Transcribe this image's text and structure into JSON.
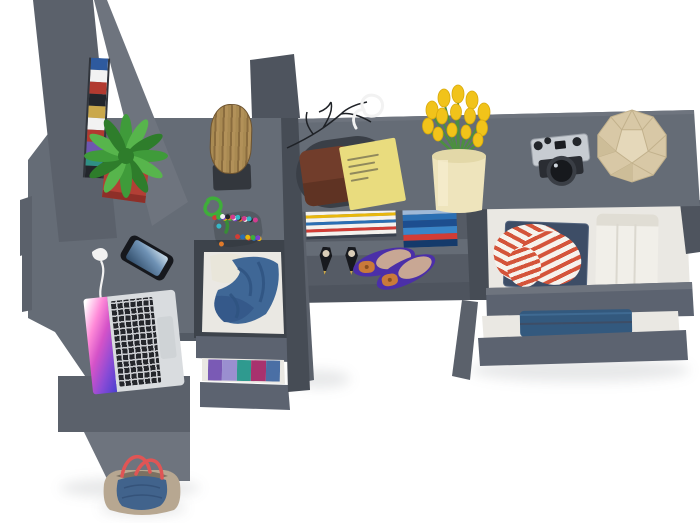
{
  "scene": {
    "kind": "3d-render-top-view",
    "background": "#ffffff"
  },
  "labels": {
    "scene": "furniture set top view",
    "wardrobe": "wardrobe columns",
    "left_desk": "corner desk",
    "middle_dresser": "dresser with open clothing drawers",
    "right_desk": "desk with open shelves",
    "chest": "chest with open drawers",
    "chair": "chair",
    "stool": "wooden log stool",
    "plant": "potted fern plant",
    "laptop": "open laptop",
    "phone": "smartphone",
    "earbuds": "white earphones",
    "pompom": "pompom toy",
    "tray": "valet tray",
    "wallet": "leather wallet",
    "notepad": "yellow notepad",
    "glasses": "white glasses",
    "branches": "decorative branches",
    "tulips": "yellow tulips in vase",
    "camera": "vintage camera",
    "polyhedron": "geometric decor object",
    "magazines": "magazine stack",
    "books": "book stack",
    "heels": "black high heels",
    "flats": "purple ballet flats",
    "shirt": "striped shirt",
    "trousers": "white folded trousers",
    "jeans": "folded jeans",
    "jacket": "denim jacket",
    "clothes": "folded colorful clothes",
    "bag": "tote bag"
  },
  "colors": {
    "surface": "#656c76",
    "panel": "#5b616b",
    "panelLight": "#6e747e",
    "dark": "#464c55",
    "deep": "#3d434b",
    "front": "#5c6370",
    "cavity": "#555b65",
    "edge": "#4e545e",
    "edgeDark": "#535a64",
    "drawerWhite": "#eae8e3",
    "potRed": "#b23f35",
    "potRedDark": "#8e2f28",
    "fern1": "#3f9b3a",
    "fern2": "#57b54c",
    "fern3": "#2e7d2b",
    "rope": "#3fae3a",
    "stems": "#4c8f3f",
    "wood": "#a98a52",
    "woodDark": "#8a6c3e",
    "woodLight": "#b29159",
    "stoolBase": "#33373d",
    "phoneBody": "#16181d",
    "silver": "#d9dcdf",
    "keys": "#24262b",
    "tray": "#3a3f47",
    "wallet": "#713d2b",
    "walletDark": "#5f3323",
    "notepad": "#e9dc7e",
    "scribble": "#90895c",
    "tulip": "#f1c31a",
    "vase": "#eee4bc",
    "vaseShade": "#e3d8a8",
    "camSilver": "#c7ccd2",
    "camBlack": "#23262b",
    "camBody": "#2a2d33",
    "poly": "#d8c8a6",
    "polyLine": "#c2b18c",
    "polyLight": "#e5d8ba",
    "polyDark": "#cdbd98",
    "heel": "#17191e",
    "gold": "#caa84c",
    "insole": "#d9cdb8",
    "flat": "#4b2fa8",
    "flatIn": "#c8a794",
    "bow": "#c97a3a",
    "stripeRed": "#d4543a",
    "shirtWhite": "#f6f2ec",
    "jeansDark": "#3d4d66",
    "jeansMid": "#33597e",
    "jeansLight": "#3f6a92",
    "trousers": "#f1efe9",
    "trousersShade": "#e0ddd4",
    "denim": "#3f6796",
    "denimDark": "#2e5280",
    "denimDeep": "#35598a",
    "garment": "#e9e6da",
    "bagBeige": "#b7a791",
    "bagDenim": "#41638c",
    "bagHandle": "#e05555",
    "bagInner": "#7c7162",
    "branch": "#1f2227",
    "cord": "#f2f2f2"
  },
  "stripes": {
    "book_spines": [
      "#2e5a9e",
      "#f2f2f2",
      "#b23a30",
      "#23262c",
      "#caa84c",
      "#f2f2f2",
      "#b23a30",
      "#6f57b0",
      "#2f8f85",
      "#23262c"
    ],
    "magazines": [
      "#f4f2ee",
      "#e8b70d",
      "#f4f2ee",
      "#2b6fb3",
      "#f4f2ee",
      "#d23c35",
      "#f4f2ee",
      "#39414e"
    ],
    "blue_books": [
      "#9fb9d8",
      "#2b6fb3",
      "#1d4e8f",
      "#3a85c8",
      "#d23c35",
      "#143a6b"
    ],
    "folded_clothes": [
      "#7a5ab5",
      "#9a8fd0",
      "#2f9a8f",
      "#a8326e",
      "#4a6fa5"
    ]
  },
  "pompom_colors": [
    "#d23c35",
    "#2b6fb3",
    "#e8b70d",
    "#3fae3a",
    "#7a3fd1",
    "#e07a2a",
    "#f2f2f2",
    "#23262c",
    "#d23c8f",
    "#35b8c8"
  ]
}
